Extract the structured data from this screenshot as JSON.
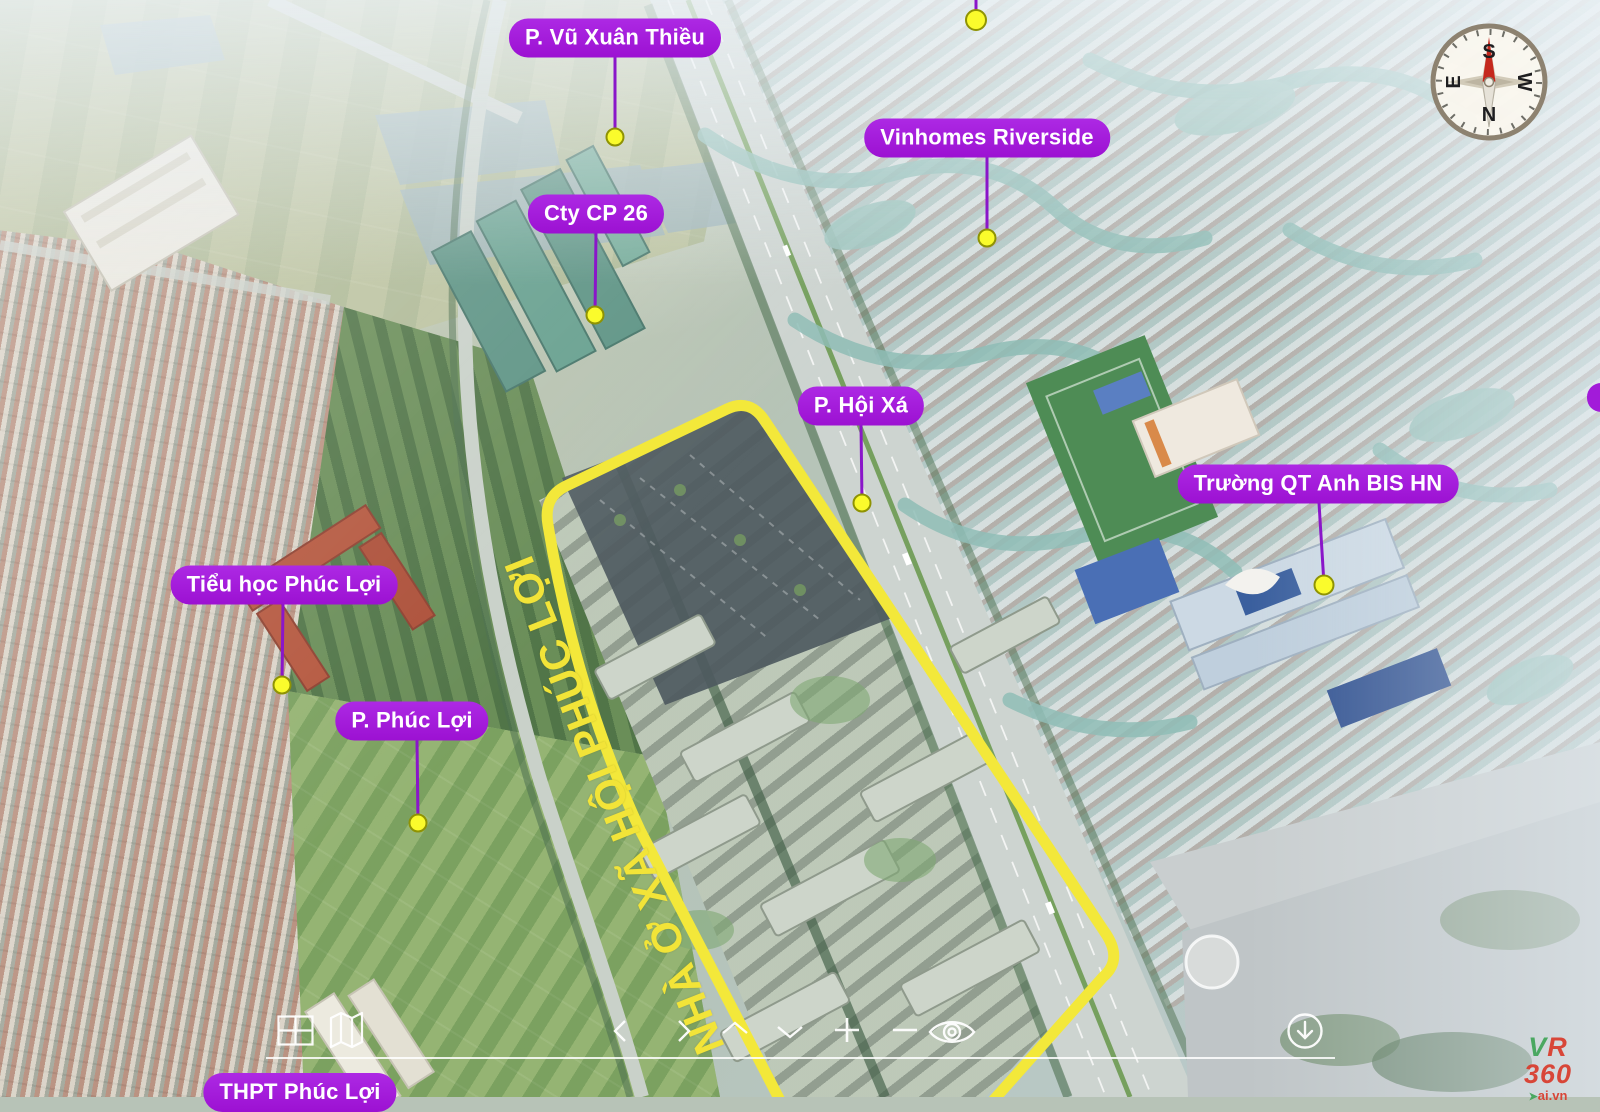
{
  "viewer": {
    "site_area_label": "NHÀ Ở XÃ HỘI PHÚC LỢI",
    "markers": [
      {
        "label": "P. Vũ Xuân Thiều"
      },
      {
        "label": "Vinhomes Riverside"
      },
      {
        "label": "Cty CP 26"
      },
      {
        "label": "P. Hội Xá"
      },
      {
        "label": "Trường QT Anh BIS HN"
      },
      {
        "label": "Tiểu học Phúc Lợi"
      },
      {
        "label": "P. Phúc Lợi"
      },
      {
        "label": "THPT Phúc Lợi"
      }
    ],
    "compass": {
      "north": "N",
      "south": "S",
      "east": "E",
      "west": "W"
    },
    "toolbar": {
      "icons": [
        "floorplan-grid-icon",
        "panorama-map-icon",
        "pan-left-icon",
        "pan-right-icon",
        "pan-up-icon",
        "pan-down-icon",
        "zoom-in-icon",
        "zoom-out-icon",
        "hide-interface-eye-icon",
        "download-arrow-icon"
      ]
    },
    "logo": {
      "letter_v": "V",
      "letter_r": "R",
      "number": "360",
      "domain": "ai.vn",
      "arrow": "➤"
    },
    "colors": {
      "marker_pill": "#a21bd9",
      "marker_dot": "#fafb2c",
      "connector_line": "#8a16c9",
      "site_boundary": "#f3e83a"
    }
  }
}
